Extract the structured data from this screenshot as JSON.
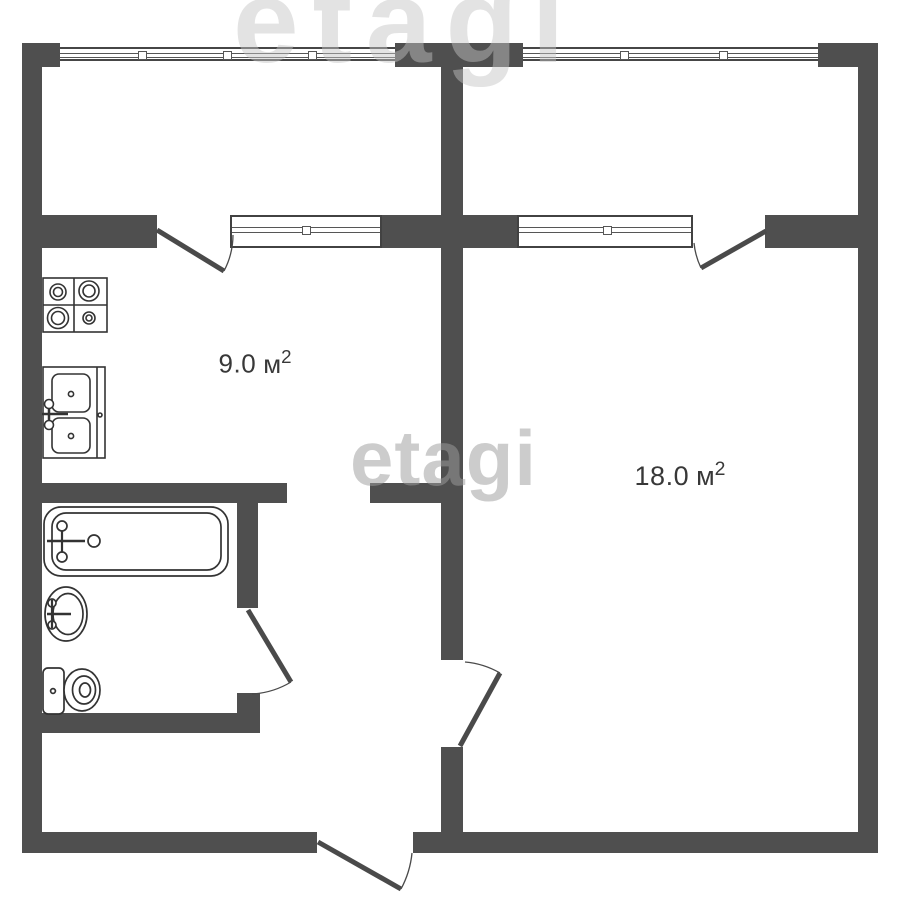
{
  "plan_type": "apartment-floor-plan",
  "colors": {
    "wall": "#4f4f4f",
    "fixture_line": "#333333",
    "background": "#ffffff",
    "label_text": "#383838",
    "watermark": "#bdbdbd"
  },
  "watermarks": {
    "center": "etagi",
    "top": "etagi"
  },
  "rooms": {
    "kitchen": {
      "area": "9.0",
      "unit": "м",
      "exponent": "2",
      "full_label": "9.0 м²"
    },
    "living_room": {
      "area": "18.0",
      "unit": "м",
      "exponent": "2",
      "full_label": "18.0 м²"
    }
  },
  "fixtures": {
    "kitchen": [
      "stove",
      "double-sink"
    ],
    "bathroom": [
      "bathtub",
      "wash-basin",
      "toilet"
    ]
  },
  "openings": {
    "windows": [
      "top-facade-left",
      "top-facade-right",
      "kitchen-balcony-window",
      "living-room-balcony-window"
    ],
    "doors": [
      "kitchen-balcony-door",
      "living-room-balcony-door",
      "bathroom-door",
      "living-room-door",
      "entry-door"
    ]
  }
}
